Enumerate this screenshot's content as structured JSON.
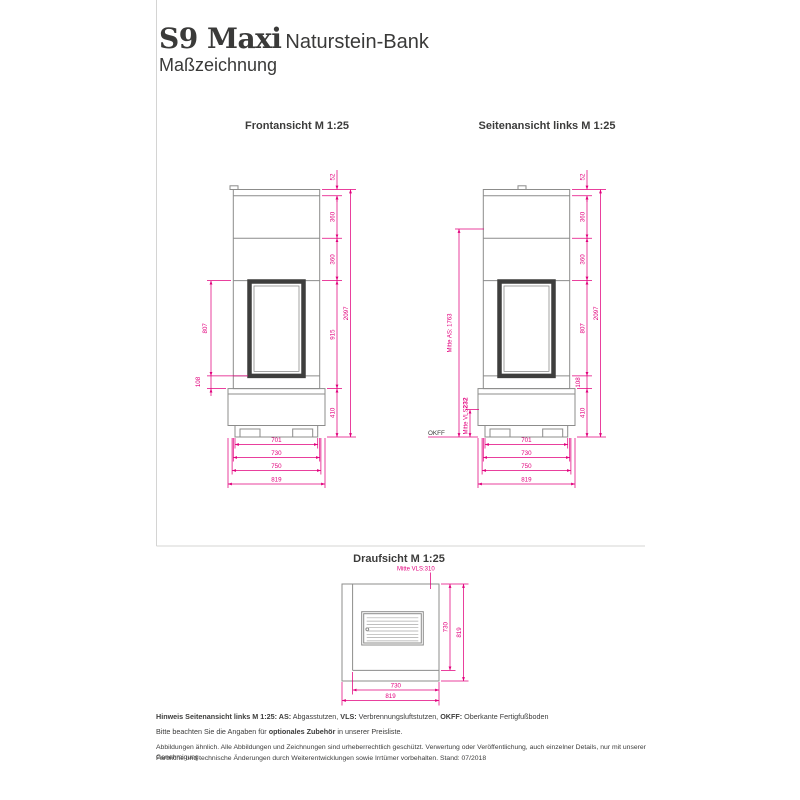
{
  "page": {
    "product": "S9 Maxi",
    "product_suffix": "Naturstein-Bank",
    "doc_type": "Maßzeichnung"
  },
  "colors": {
    "dimension_magenta": "#e2007d",
    "drawing_outline_gray": "#8c8c8b",
    "door_dark": "#3e3e3d",
    "text_dark": "#3c3c3b"
  },
  "views": {
    "front": {
      "title": "Frontansicht M 1:25",
      "dims": {
        "total_height": "2097",
        "top_slab": "52",
        "segment_upper": "360",
        "segment_mid": "360",
        "segment_door_area": "915",
        "bench_height": "410",
        "door_height": "807",
        "door_offset": "108",
        "width_plinth": "701",
        "width_body": "730",
        "width_slab": "750",
        "width_total": "819"
      }
    },
    "side": {
      "title": "Seitenansicht links M 1:25",
      "dims": {
        "total_height": "2097",
        "top_slab": "52",
        "segment_upper": "360",
        "segment_mid": "360",
        "door_height": "807",
        "door_offset": "108",
        "bench_height": "410",
        "mitte_as": "Mitte AS: 1763",
        "mitte_vls_label": "Mitte VLS",
        "mitte_vls_value": "232",
        "okff": "OKFF",
        "depth_plinth": "701",
        "depth_body": "730",
        "depth_slab": "750",
        "depth_total": "819"
      }
    },
    "top": {
      "title": "Draufsicht M 1:25",
      "dims": {
        "mitte_vls": "Mitte VLS:310",
        "depth_body": "730",
        "depth_total": "819",
        "width_body": "730",
        "width_total": "819"
      }
    }
  },
  "footer": {
    "hinweis_b1": "Hinweis Seitenansicht links M 1:25: AS:",
    "hinweis_n1": " Abgasstutzen, ",
    "hinweis_b2": "VLS:",
    "hinweis_n2": " Verbrennungsluftstutzen, ",
    "hinweis_b3": "OKFF:",
    "hinweis_n3": " Oberkante Fertigfußboden",
    "zubehoer_n1": "Bitte beachten Sie die Angaben für ",
    "zubehoer_b": "optionales Zubehör",
    "zubehoer_n2": " in unserer Preisliste.",
    "copyright1": "Abbildungen ähnlich. Alle Abbildungen und Zeichnungen sind urheberrechtlich geschützt. Verwertung oder Veröffentlichung, auch einzelner Details, nur mit unserer Genehmigung.",
    "copyright2": "Farbliche und technische Änderungen durch Weiterentwicklungen sowie Irrtümer vorbehalten. Stand: 07/2018"
  }
}
